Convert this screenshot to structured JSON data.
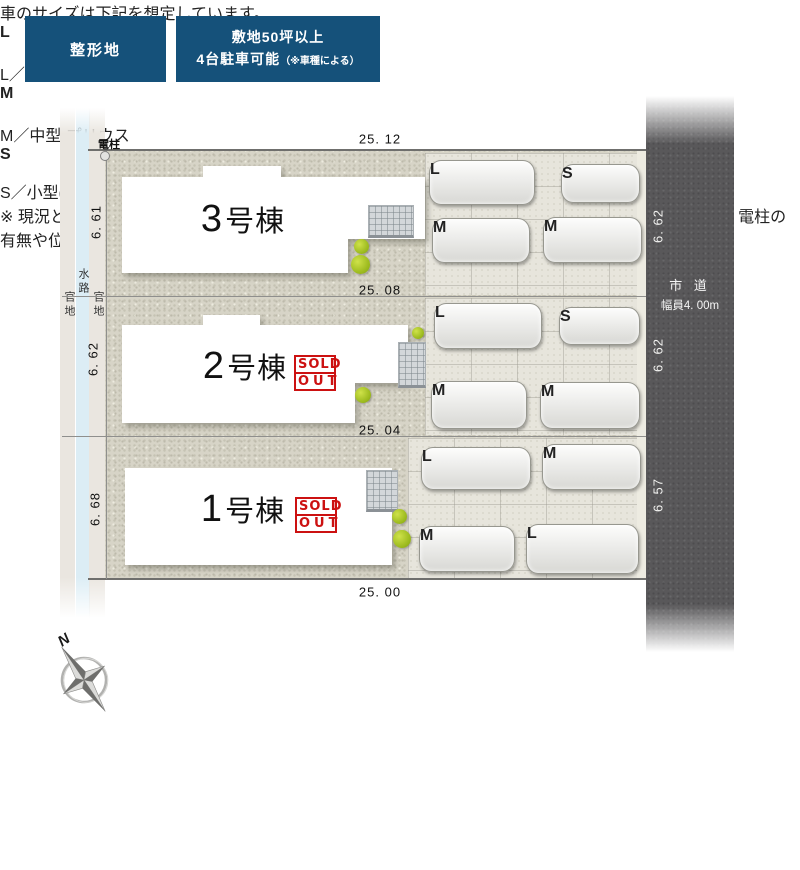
{
  "header": {
    "badge_shape": "整形地",
    "badge_site_line1": "敷地50坪以上",
    "badge_site_line2": "4台駐車可能",
    "badge_site_note": "（※車種による）"
  },
  "plan": {
    "pole": "電柱",
    "strips": {
      "left": "官地",
      "middle": "水路",
      "right": "官地"
    },
    "dims": {
      "top": "25. 12",
      "mid1": "25. 08",
      "mid2": "25. 04",
      "bottom": "25. 00",
      "left1": "6. 61",
      "left2": "6. 62",
      "left3": "6. 68",
      "right1": "6. 62",
      "right2": "6. 62",
      "right3": "6. 57"
    },
    "road": {
      "name": "市 道",
      "width": "幅員4. 00m"
    },
    "buildings": [
      {
        "num": "3",
        "suffix": "号棟",
        "sold_out": false
      },
      {
        "num": "2",
        "suffix": "号棟",
        "sold_out": true
      },
      {
        "num": "1",
        "suffix": "号棟",
        "sold_out": true
      }
    ],
    "sold_stamp": {
      "line1": "SOLD",
      "line2": "OUT"
    },
    "parking": {
      "row1": [
        "L",
        "S",
        "M",
        "M"
      ],
      "row2": [
        "L",
        "S",
        "M",
        "M"
      ],
      "row3": [
        "L",
        "M",
        "M",
        "L"
      ]
    }
  },
  "compass": {
    "north": "N"
  },
  "legend": {
    "title": "車のサイズは下記を想定しています。",
    "items": [
      {
        "label": "L",
        "size": "L／大型",
        "model": "クラウン"
      },
      {
        "label": "M",
        "size": "M／中型",
        "model": "プリウス"
      },
      {
        "label": "S",
        "size": "S／小型(軽)",
        "model": "アルト"
      }
    ]
  },
  "footer": {
    "note1": "※ 現況と図面が異なる場合、現況を優先します。",
    "note2": "※完成前の図面のため、配置図上の駐車位置や台数、電柱の有無や位置、境界ブロックなどが実際と異なる場合があります。",
    "note3": "詳しくはお問い合わせください。"
  },
  "colors": {
    "badge_blue": "#15517a",
    "road_gray": "#59585a",
    "waterway_blue": "#dcedf5",
    "public_land": "#eae6e0",
    "gravel": "#d7d4c7",
    "sold_red": "#cc1111"
  }
}
